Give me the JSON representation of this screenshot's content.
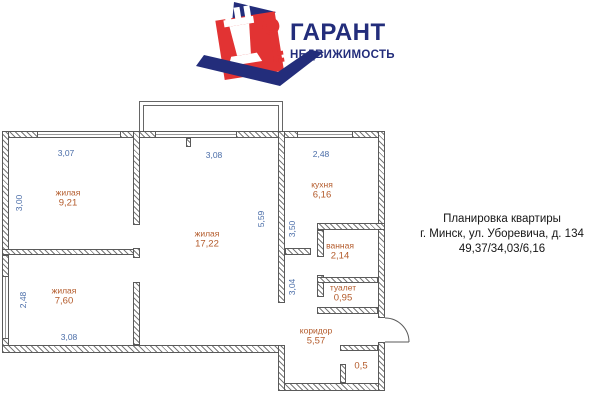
{
  "logo": {
    "title": "ГАРАНТ",
    "subtitle": "НЕДВИЖИМОСТЬ"
  },
  "info": {
    "line1": "Планировка квартиры",
    "line2": "г. Минск, ул. Уборевича, д. 134",
    "line3": "49,37/34,03/6,16"
  },
  "plan": {
    "rooms": {
      "living1": {
        "label": "жилая",
        "area": "9,21"
      },
      "living2": {
        "label": "жилая",
        "area": "17,22"
      },
      "living3": {
        "label": "жилая",
        "area": "7,60"
      },
      "kitchen": {
        "label": "кухня",
        "area": "6,16"
      },
      "bathroom": {
        "label": "ванная",
        "area": "2,14"
      },
      "toilet": {
        "label": "туалет",
        "area": "0,95"
      },
      "corridor": {
        "label": "коридор",
        "area": "5,57"
      },
      "closet": {
        "area": "0,5"
      }
    },
    "dimensions": {
      "living1_width": "3,07",
      "living1_height": "3,00",
      "living2_width": "3,08",
      "living2_height": "5,59",
      "kitchen_width": "2,48",
      "hall_upper": "3,50",
      "hall_lower": "3,04",
      "living3_height": "2,48",
      "living3_width": "3,08"
    }
  },
  "colors": {
    "navy": "#232d7b",
    "red": "#e23333",
    "dimension_blue": "#4a6da8",
    "room_label_orange": "#b35a2a"
  }
}
